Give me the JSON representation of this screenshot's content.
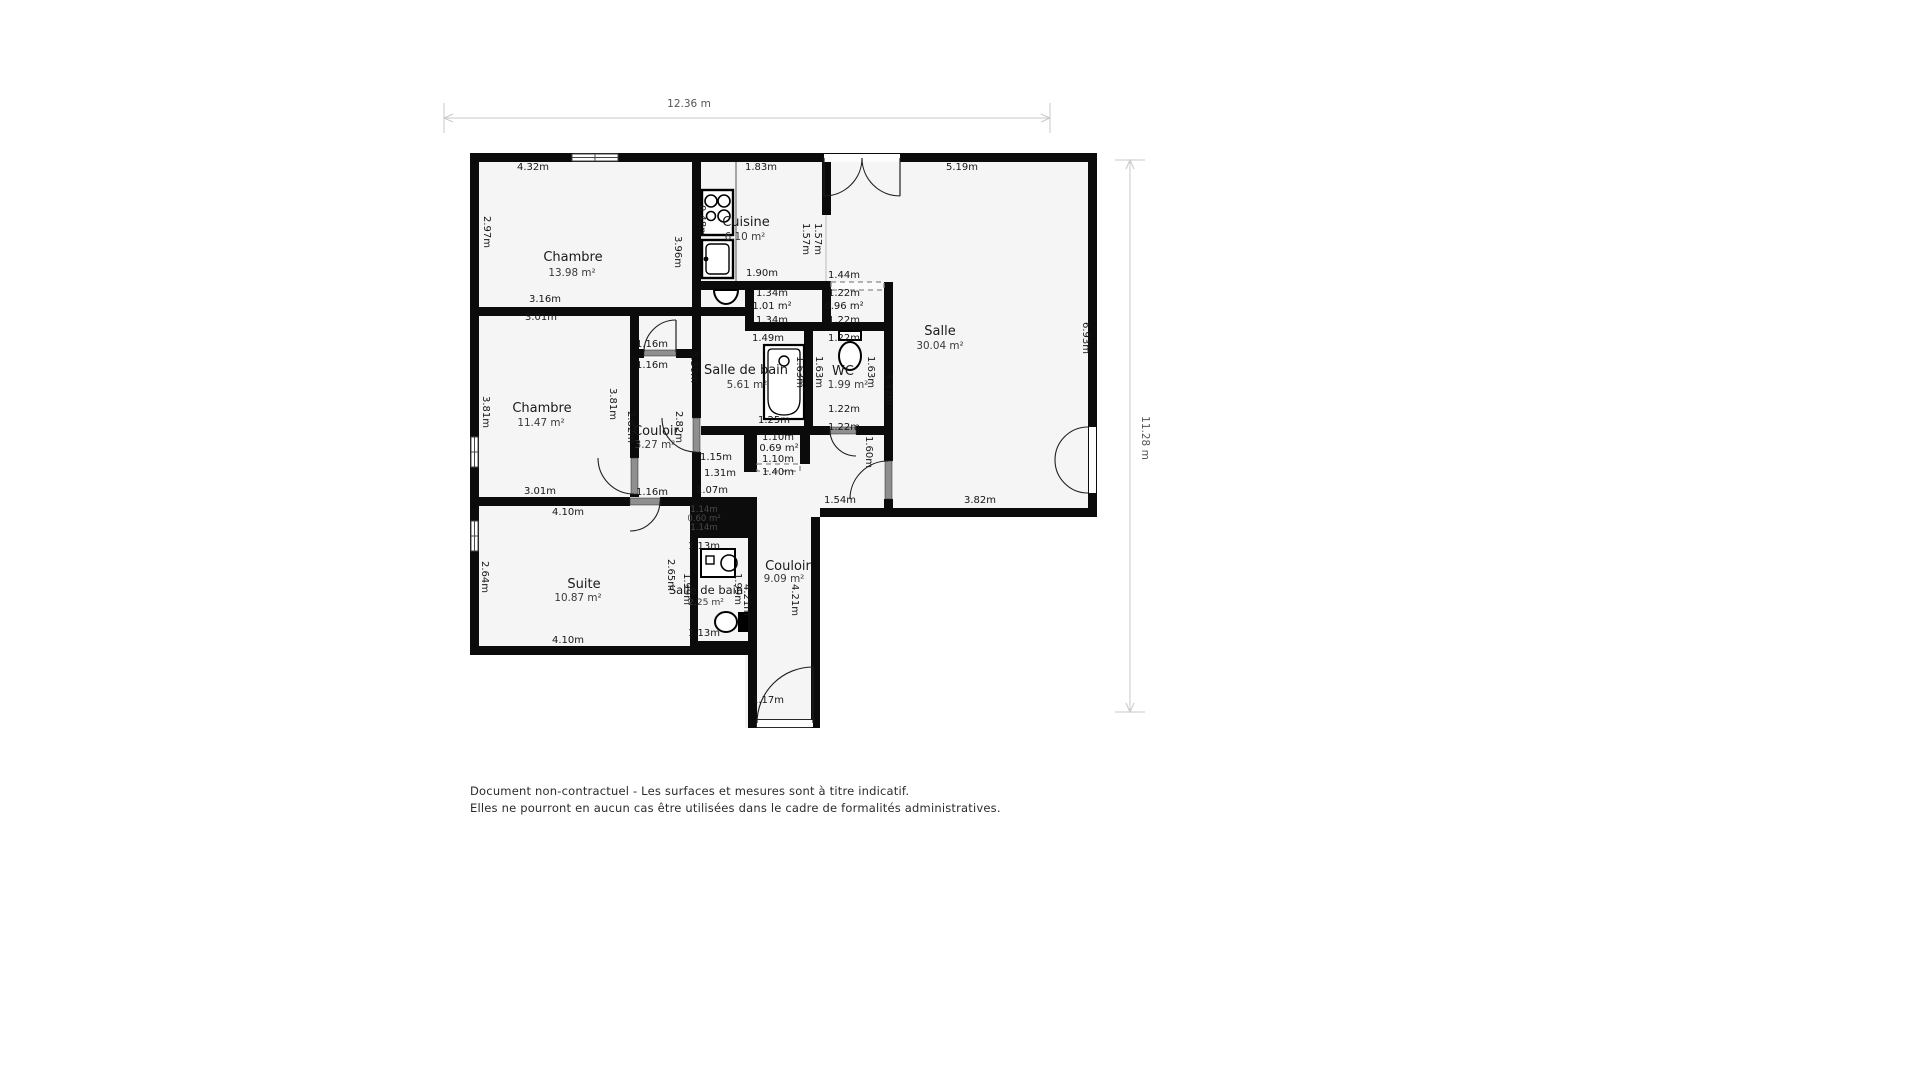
{
  "meta": {
    "disclaimer_line1": "Document non-contractuel - Les surfaces et mesures sont à titre indicatif.",
    "disclaimer_line2": "Elles ne pourront en aucun cas être utilisées dans le cadre de formalités administratives."
  },
  "colors": {
    "wall": "#0b0b0b",
    "floor": "#f5f5f5",
    "door_slab": "#8f8f8f",
    "arc": "#1f1f1f",
    "dashed": "#8a8a8a",
    "dim_line": "#c9c9c9",
    "shaft_label": "#4a4a4a"
  },
  "plan": {
    "floor": {
      "points": "470,153 1097,153 1097,517 820,517 820,728 745,728 745,655 470,655"
    },
    "walls": [
      [
        470,
        153,
        627,
        9
      ],
      [
        470,
        162,
        9,
        493
      ],
      [
        1088,
        162,
        9,
        346
      ],
      [
        820,
        508,
        277,
        9
      ],
      [
        811,
        517,
        9,
        202
      ],
      [
        748,
        719,
        72,
        9
      ],
      [
        748,
        646,
        9,
        73
      ],
      [
        470,
        646,
        287,
        9
      ],
      [
        692,
        162,
        9,
        145
      ],
      [
        470,
        307,
        231,
        9
      ],
      [
        701,
        307,
        44,
        9
      ],
      [
        630,
        316,
        9,
        142
      ],
      [
        630,
        494,
        9,
        12
      ],
      [
        639,
        349,
        5,
        9
      ],
      [
        676,
        349,
        16,
        9
      ],
      [
        692,
        316,
        9,
        102
      ],
      [
        692,
        452,
        9,
        54
      ],
      [
        701,
        281,
        130,
        9
      ],
      [
        822,
        162,
        9,
        53
      ],
      [
        745,
        287,
        9,
        35
      ],
      [
        822,
        290,
        9,
        32
      ],
      [
        884,
        282,
        9,
        153
      ],
      [
        884,
        435,
        9,
        26
      ],
      [
        884,
        499,
        9,
        9
      ],
      [
        745,
        322,
        148,
        9
      ],
      [
        804,
        331,
        9,
        95
      ],
      [
        701,
        426,
        112,
        9
      ],
      [
        813,
        426,
        17,
        9
      ],
      [
        856,
        426,
        37,
        9
      ],
      [
        744,
        435,
        13,
        37
      ],
      [
        800,
        435,
        10,
        29
      ],
      [
        470,
        497,
        160,
        9
      ],
      [
        660,
        497,
        41,
        9
      ],
      [
        690,
        538,
        8,
        103
      ],
      [
        748,
        538,
        9,
        103
      ],
      [
        690,
        641,
        67,
        9
      ]
    ],
    "shaft": {
      "rect": [
        690,
        497,
        67,
        41
      ]
    },
    "windows": [
      {
        "rect": [
          572,
          154,
          46,
          7
        ],
        "dir": "h"
      },
      {
        "rect": [
          471,
          437,
          7,
          30
        ],
        "dir": "v"
      },
      {
        "rect": [
          471,
          521,
          7,
          30
        ],
        "dir": "v"
      },
      {
        "rect": [
          757,
          720,
          54,
          7
        ],
        "dir": "h"
      }
    ],
    "dashed_openings": [
      {
        "rect": [
          831,
          282,
          53,
          8
        ]
      },
      {
        "rect": [
          757,
          464,
          43,
          7
        ]
      }
    ],
    "passage_lines": [
      {
        "x1": 826,
        "y1": 215,
        "x2": 826,
        "y2": 281
      }
    ],
    "doors": [
      {
        "gap": [
          824,
          154,
          76,
          8
        ],
        "slab": null,
        "arcs": [
          "M862,158 A38 38 0 0 1 824,196",
          "M862,158 A38 38 0 0 0 900,196"
        ],
        "leaves": [
          [
            824,
            158,
            824,
            196
          ],
          [
            900,
            158,
            900,
            196
          ]
        ]
      },
      {
        "gap": [
          644,
          349,
          32,
          9
        ],
        "slab": [
          644,
          350,
          32,
          6
        ],
        "arcs": [
          "M644,352 A32 32 0 0 1 676,320"
        ],
        "leaves": [
          [
            676,
            352,
            676,
            320
          ]
        ]
      },
      {
        "gap": [
          692,
          418,
          9,
          34
        ],
        "slab": [
          693,
          418,
          7,
          34
        ],
        "arcs": [
          "M662,418 A34 34 0 0 0 696,452"
        ],
        "leaves": []
      },
      {
        "gap": [
          830,
          426,
          26,
          9
        ],
        "slab": [
          830,
          427,
          26,
          7
        ],
        "arcs": [
          "M830,430 A26 26 0 0 0 856,456"
        ],
        "leaves": []
      },
      {
        "gap": [
          630,
          458,
          9,
          36
        ],
        "slab": [
          631,
          458,
          7,
          36
        ],
        "arcs": [
          "M598,458 A36 36 0 0 0 634,494"
        ],
        "leaves": []
      },
      {
        "gap": [
          630,
          497,
          30,
          9
        ],
        "slab": [
          630,
          498,
          30,
          7
        ],
        "arcs": [
          "M660,501 A30 30 0 0 1 630,531"
        ],
        "leaves": []
      },
      {
        "gap": [
          884,
          461,
          9,
          38
        ],
        "slab": [
          885,
          461,
          7,
          38
        ],
        "arcs": [
          "M888,461 A38 38 0 0 0 850,499"
        ],
        "leaves": []
      },
      {
        "gap": [
          757,
          720,
          56,
          7
        ],
        "slab": null,
        "arcs": [
          "M757,723 A56 56 0 0 1 813,667"
        ],
        "leaves": [
          [
            813,
            723,
            813,
            667
          ]
        ]
      },
      {
        "gap": [
          1089,
          427,
          7,
          66
        ],
        "slab": null,
        "arcs": [
          "M1088,427 A33 33 0 0 0 1055,460",
          "M1088,493 A33 33 0 0 1 1055,460"
        ],
        "leaves": []
      }
    ],
    "fixtures": {
      "stove": {
        "rect": [
          702,
          190,
          31,
          45
        ],
        "burners": [
          [
            711,
            201,
            6
          ],
          [
            724,
            201,
            6
          ],
          [
            711,
            216,
            4.5
          ],
          [
            724,
            216,
            6
          ]
        ]
      },
      "sink": {
        "rect": [
          702,
          240,
          31,
          38
        ],
        "basin": [
          706,
          244,
          23,
          30
        ]
      },
      "counter": {
        "line": [
          736,
          162,
          736,
          281
        ]
      },
      "hand_basin": {
        "path": "M714,290 A12 14 0 0 0 738,290 Z",
        "wall_y": 290
      },
      "bathtub": {
        "rect": [
          764,
          345,
          40,
          74
        ],
        "inner": [
          768,
          349,
          32,
          66
        ],
        "drain": [
          784,
          361,
          5
        ]
      },
      "toilet_wc": {
        "tank": [
          839,
          331,
          22,
          9
        ],
        "bowl": [
          850,
          356,
          11,
          14
        ]
      },
      "toilet_sdb": {
        "tank": [
          738,
          612,
          10,
          20
        ],
        "bowl": [
          726,
          622,
          11,
          10
        ]
      },
      "washer": {
        "rect": [
          701,
          549,
          34,
          28
        ],
        "square": [
          706,
          556,
          8,
          8
        ],
        "door": [
          729,
          563,
          8
        ]
      }
    },
    "rooms": [
      {
        "name": "Chambre",
        "area": "13.98 m²",
        "x": 573,
        "y": 261,
        "ax": 572,
        "ay": 276,
        "fs": 13
      },
      {
        "name": "Cuisine",
        "area": "6.10 m²",
        "x": 746,
        "y": 226,
        "ax": 745,
        "ay": 240,
        "fs": 13
      },
      {
        "name": "Salle",
        "area": "30.04 m²",
        "x": 940,
        "y": 335,
        "ax": 940,
        "ay": 349,
        "fs": 13
      },
      {
        "name": "Salle de bain",
        "area": "5.61 m²",
        "x": 746,
        "y": 374,
        "ax": 747,
        "ay": 388,
        "fs": 13
      },
      {
        "name": "WC",
        "area": "1.99 m²",
        "x": 843,
        "y": 375,
        "ax": 848,
        "ay": 388,
        "fs": 13
      },
      {
        "name": "Couloir",
        "area": "3.27 m²",
        "x": 656,
        "y": 435,
        "ax": 655,
        "ay": 448,
        "fs": 13
      },
      {
        "name": "Chambre",
        "area": "11.47 m²",
        "x": 542,
        "y": 412,
        "ax": 541,
        "ay": 426,
        "fs": 13
      },
      {
        "name": "Suite",
        "area": "10.87 m²",
        "x": 584,
        "y": 588,
        "ax": 578,
        "ay": 601,
        "fs": 13
      },
      {
        "name": "Salle de bain",
        "area": "2.25 m²",
        "x": 706,
        "y": 594,
        "ax": 706,
        "ay": 605,
        "fs": 11.5
      },
      {
        "name": "Couloir",
        "area": "9.09 m²",
        "x": 788,
        "y": 570,
        "ax": 784,
        "ay": 582,
        "fs": 13
      }
    ],
    "measurements": [
      {
        "t": "4.32m",
        "x": 533,
        "y": 170,
        "r": 0
      },
      {
        "t": "1.83m",
        "x": 761,
        "y": 170,
        "r": 0
      },
      {
        "t": "5.19m",
        "x": 962,
        "y": 170,
        "r": 0
      },
      {
        "t": "2.97m",
        "x": 484,
        "y": 232,
        "r": 90
      },
      {
        "t": "3.96m",
        "x": 675,
        "y": 252,
        "r": 90
      },
      {
        "t": "0.48m",
        "x": 699,
        "y": 221,
        "r": 90
      },
      {
        "t": "1.57m",
        "x": 803,
        "y": 239,
        "r": 90
      },
      {
        "t": "1.57m",
        "x": 815,
        "y": 239,
        "r": 90
      },
      {
        "t": "1.90m",
        "x": 762,
        "y": 276,
        "r": 0
      },
      {
        "t": "1.44m",
        "x": 844,
        "y": 278,
        "r": 0
      },
      {
        "t": "1.34m",
        "x": 772,
        "y": 296,
        "r": 0
      },
      {
        "t": "1.01 m²",
        "x": 772,
        "y": 309,
        "r": 0
      },
      {
        "t": "1.34m",
        "x": 772,
        "y": 323,
        "r": 0
      },
      {
        "t": "1.22m",
        "x": 844,
        "y": 296,
        "r": 0
      },
      {
        "t": "0.96 m²",
        "x": 844,
        "y": 309,
        "r": 0
      },
      {
        "t": "1.22m",
        "x": 844,
        "y": 323,
        "r": 0
      },
      {
        "t": "1.49m",
        "x": 768,
        "y": 341,
        "r": 0
      },
      {
        "t": "1.22m",
        "x": 844,
        "y": 341,
        "r": 0
      },
      {
        "t": "3.16m",
        "x": 545,
        "y": 302,
        "r": 0
      },
      {
        "t": "3.01m",
        "x": 541,
        "y": 320,
        "r": 0
      },
      {
        "t": "1.16m",
        "x": 652,
        "y": 347,
        "r": 0
      },
      {
        "t": "1.16m",
        "x": 652,
        "y": 368,
        "r": 0
      },
      {
        "t": "6.93m",
        "x": 1083,
        "y": 338,
        "r": 90
      },
      {
        "t": "3.81m",
        "x": 483,
        "y": 412,
        "r": 90
      },
      {
        "t": "3.81m",
        "x": 610,
        "y": 404,
        "r": 90
      },
      {
        "t": "2.82m",
        "x": 628,
        "y": 427,
        "r": 90
      },
      {
        "t": "2.82m",
        "x": 676,
        "y": 427,
        "r": 90
      },
      {
        "t": "3.30m",
        "x": 691,
        "y": 367,
        "r": 90
      },
      {
        "t": "1.63m",
        "x": 797,
        "y": 372,
        "r": 90
      },
      {
        "t": "1.63m",
        "x": 816,
        "y": 372,
        "r": 90
      },
      {
        "t": "1.63m",
        "x": 868,
        "y": 372,
        "r": 90
      },
      {
        "t": "4.42m",
        "x": 886,
        "y": 389,
        "r": 90
      },
      {
        "t": "1.25m",
        "x": 774,
        "y": 423,
        "r": 0
      },
      {
        "t": "1.22m",
        "x": 844,
        "y": 412,
        "r": 0
      },
      {
        "t": "1.22m",
        "x": 844,
        "y": 430,
        "r": 0
      },
      {
        "t": "1.60m",
        "x": 866,
        "y": 452,
        "r": 90
      },
      {
        "t": "1.15m",
        "x": 716,
        "y": 460,
        "r": 0
      },
      {
        "t": "1.31m",
        "x": 720,
        "y": 476,
        "r": 0
      },
      {
        "t": "1.10m",
        "x": 778,
        "y": 440,
        "r": 0
      },
      {
        "t": "0.69 m²",
        "x": 779,
        "y": 451,
        "r": 0
      },
      {
        "t": "1.10m",
        "x": 778,
        "y": 462,
        "r": 0
      },
      {
        "t": "1.40m",
        "x": 778,
        "y": 475,
        "r": 0
      },
      {
        "t": "3.01m",
        "x": 540,
        "y": 494,
        "r": 0
      },
      {
        "t": "1.16m",
        "x": 652,
        "y": 495,
        "r": 0
      },
      {
        "t": "1.07m",
        "x": 712,
        "y": 493,
        "r": 0
      },
      {
        "t": "1.54m",
        "x": 840,
        "y": 503,
        "r": 0
      },
      {
        "t": "3.82m",
        "x": 980,
        "y": 503,
        "r": 0
      },
      {
        "t": "4.10m",
        "x": 568,
        "y": 515,
        "r": 0
      },
      {
        "t": "2.64m",
        "x": 482,
        "y": 577,
        "r": 90
      },
      {
        "t": "2.65m",
        "x": 668,
        "y": 575,
        "r": 90
      },
      {
        "t": "1.99m",
        "x": 684,
        "y": 589,
        "r": 90
      },
      {
        "t": "1.99m",
        "x": 735,
        "y": 589,
        "r": 90
      },
      {
        "t": "4.21m",
        "x": 744,
        "y": 600,
        "r": 90
      },
      {
        "t": "4.21m",
        "x": 792,
        "y": 600,
        "r": 90
      },
      {
        "t": "1.13m",
        "x": 704,
        "y": 549,
        "r": 0
      },
      {
        "t": "1.13m",
        "x": 704,
        "y": 636,
        "r": 0
      },
      {
        "t": "4.10m",
        "x": 568,
        "y": 643,
        "r": 0
      },
      {
        "t": "1.17m",
        "x": 768,
        "y": 703,
        "r": 0
      }
    ],
    "shaft_labels": [
      {
        "t": "1.14m",
        "x": 704,
        "y": 512
      },
      {
        "t": "0.60 m²",
        "x": 704,
        "y": 521
      },
      {
        "t": "1.14m",
        "x": 704,
        "y": 530
      }
    ],
    "dims": {
      "top": {
        "label": "12.36 m",
        "x1": 444,
        "x2": 1050,
        "y": 118,
        "lx": 689,
        "ly": 107
      },
      "right": {
        "label": "11.28 m",
        "y1": 160,
        "y2": 712,
        "x": 1130,
        "lx": 1142,
        "ly": 438
      }
    }
  }
}
